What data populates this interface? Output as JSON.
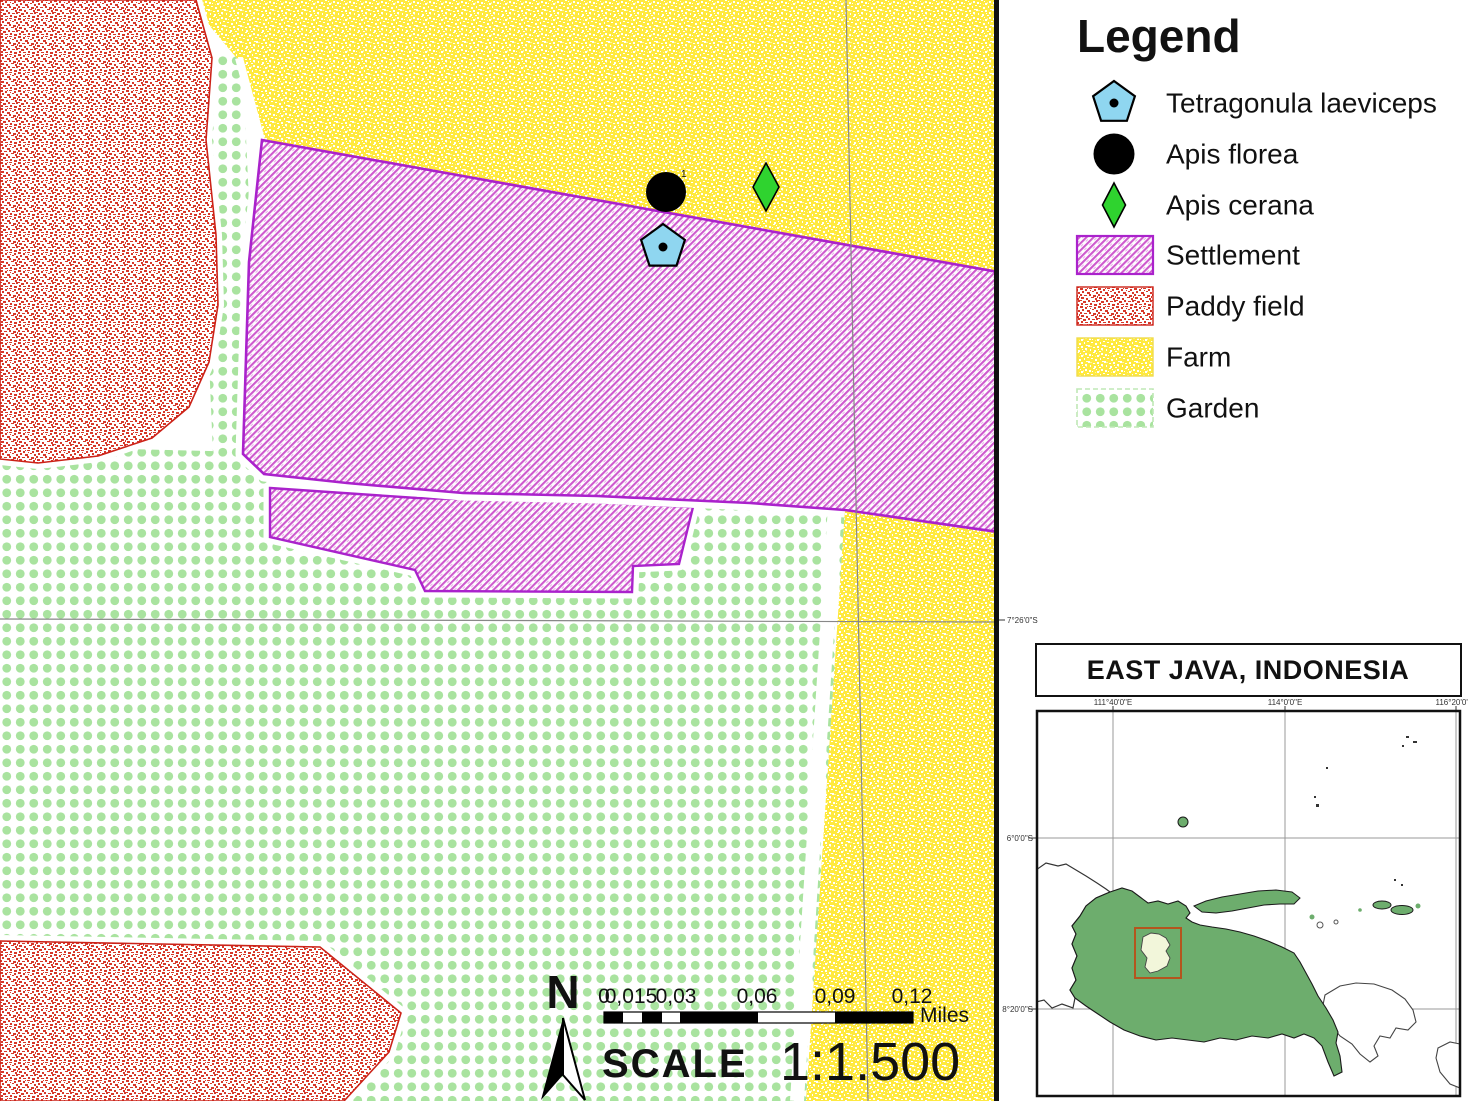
{
  "legend": {
    "title": "Legend",
    "items": [
      {
        "label": "Tetragonula laeviceps",
        "symbol": "blue-pentagon-with-dot",
        "color": "#8FD6F0"
      },
      {
        "label": "Apis florea",
        "symbol": "black-circle",
        "color": "#000000"
      },
      {
        "label": "Apis cerana",
        "symbol": "green-diamond",
        "color": "#2FD32F"
      },
      {
        "label": "Settlement",
        "symbol": "magenta-hatch-swatch",
        "color": "#CE5ACE"
      },
      {
        "label": "Paddy field",
        "symbol": "red-speckle-swatch",
        "color": "#D6382A"
      },
      {
        "label": "Farm",
        "symbol": "yellow-speckle-swatch",
        "color": "#FFE93E"
      },
      {
        "label": "Garden",
        "symbol": "green-dot-swatch",
        "color": "#A9E39F"
      }
    ]
  },
  "map": {
    "site_label": "1",
    "lat_grid_label": "7°26'0\"S",
    "markers": [
      {
        "species": "Apis florea",
        "symbol": "black-circle"
      },
      {
        "species": "Apis cerana",
        "symbol": "green-diamond"
      },
      {
        "species": "Tetragonula laeviceps",
        "symbol": "blue-pentagon-with-dot"
      }
    ]
  },
  "scale_bar": {
    "ticks": [
      "0",
      "0,015",
      "0,03",
      "0,06",
      "0,09",
      "0,12"
    ],
    "unit": "Miles",
    "scale_word": "SCALE",
    "ratio": "1:1.500"
  },
  "north_arrow": {
    "label": "N"
  },
  "inset": {
    "title": "EAST JAVA, INDONESIA",
    "x_labels": [
      "111°40'0\"E",
      "114°0'0\"E",
      "116°20'0\"E"
    ],
    "y_labels": [
      "6°0'0\"S",
      "8°20'0\"S"
    ]
  },
  "colors": {
    "settlement_border": "#AA22CC",
    "settlement_hatch": "#CE5ACE",
    "paddy_speckle": "#D6382A",
    "farm_base": "#FFE93E",
    "garden_dot": "#A9E39F",
    "tetragonula_fill": "#8FD6F0",
    "apis_cerana_fill": "#2FD32F",
    "apis_florea_fill": "#000000",
    "inset_land": "#6DAD6D",
    "study_area_box": "#B4551E"
  }
}
